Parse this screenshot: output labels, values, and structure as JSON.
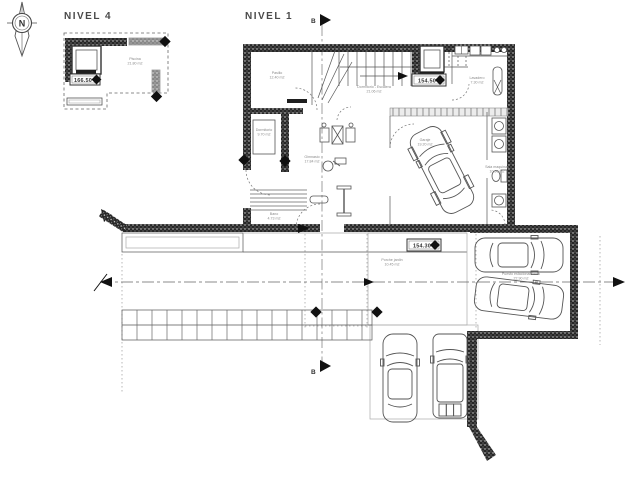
{
  "colors": {
    "line": "#3a3a3a",
    "wall": "#1f1f1f",
    "muted": "#8a8a8a",
    "light": "#aaaaaa"
  },
  "compass": {
    "letter": "N"
  },
  "nivel4": {
    "title": "NIVEL 4",
    "elevation": "166.50",
    "pool": {
      "name": "Piscina",
      "area": "21.80 m2"
    }
  },
  "nivel1": {
    "title": "NIVEL 1",
    "section_letter_top": "B",
    "section_letter_bottom": "B",
    "elevation_main": "154.50",
    "elevation_terrace": "154.30",
    "rooms": {
      "pasillo": {
        "name": "Pasillo",
        "area": "12.40 m2"
      },
      "dormitorio_escalera": {
        "name": "Dormitorio - Escalera",
        "area": "21.06 m2"
      },
      "lavadero": {
        "name": "Lavadero",
        "area": "7.30 m2"
      },
      "dormitorio": {
        "name": "Dormitorio",
        "area": "9.70 m2"
      },
      "gimnasio": {
        "name": "Gimnasio",
        "area": "17.84 m2"
      },
      "garaje": {
        "name": "Garaje",
        "area": "19.20 m2"
      },
      "sala_maquinas": {
        "name": "Sala maquinas",
        "area": "10.90 m2"
      },
      "bano": {
        "name": "Bano",
        "area": "4.73 m2"
      },
      "porche": {
        "name": "Porche jardin",
        "area": "10.45 m2"
      },
      "puesto": {
        "name": "Puesto estacionamiento",
        "area": "22.90 m2"
      }
    }
  }
}
